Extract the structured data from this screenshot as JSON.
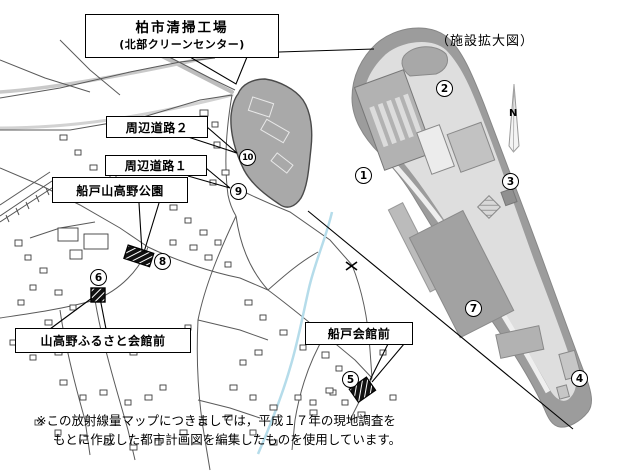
{
  "title_box": {
    "line1": "柏市清掃工場",
    "line2": "(北部クリーンセンター)"
  },
  "enlarged_view_caption": "（施設拡大図）",
  "north_label": "N",
  "labels": {
    "road2": "周辺道路２",
    "road1": "周辺道路１",
    "park": "船戸山高野公園",
    "hall": "山高野ふるさと会館前",
    "funado_hall": "船戸会館前"
  },
  "markers": [
    {
      "number": "1"
    },
    {
      "number": "2"
    },
    {
      "number": "3"
    },
    {
      "number": "4"
    },
    {
      "number": "5"
    },
    {
      "number": "6"
    },
    {
      "number": "7"
    },
    {
      "number": "8"
    },
    {
      "number": "9"
    },
    {
      "number": "10"
    }
  ],
  "note": {
    "line1": "※この放射線量マップにつきましては，平成１７年の現地調査を",
    "line2": "もとに作成した都市計画図を編集したものを使用しています。"
  },
  "colors": {
    "plant_site": "#a9a9a9",
    "facility_band": "#9c9c9c",
    "facility_ground": "#dedede",
    "building": "#b2b2b2",
    "stream": "#b5dcea"
  }
}
